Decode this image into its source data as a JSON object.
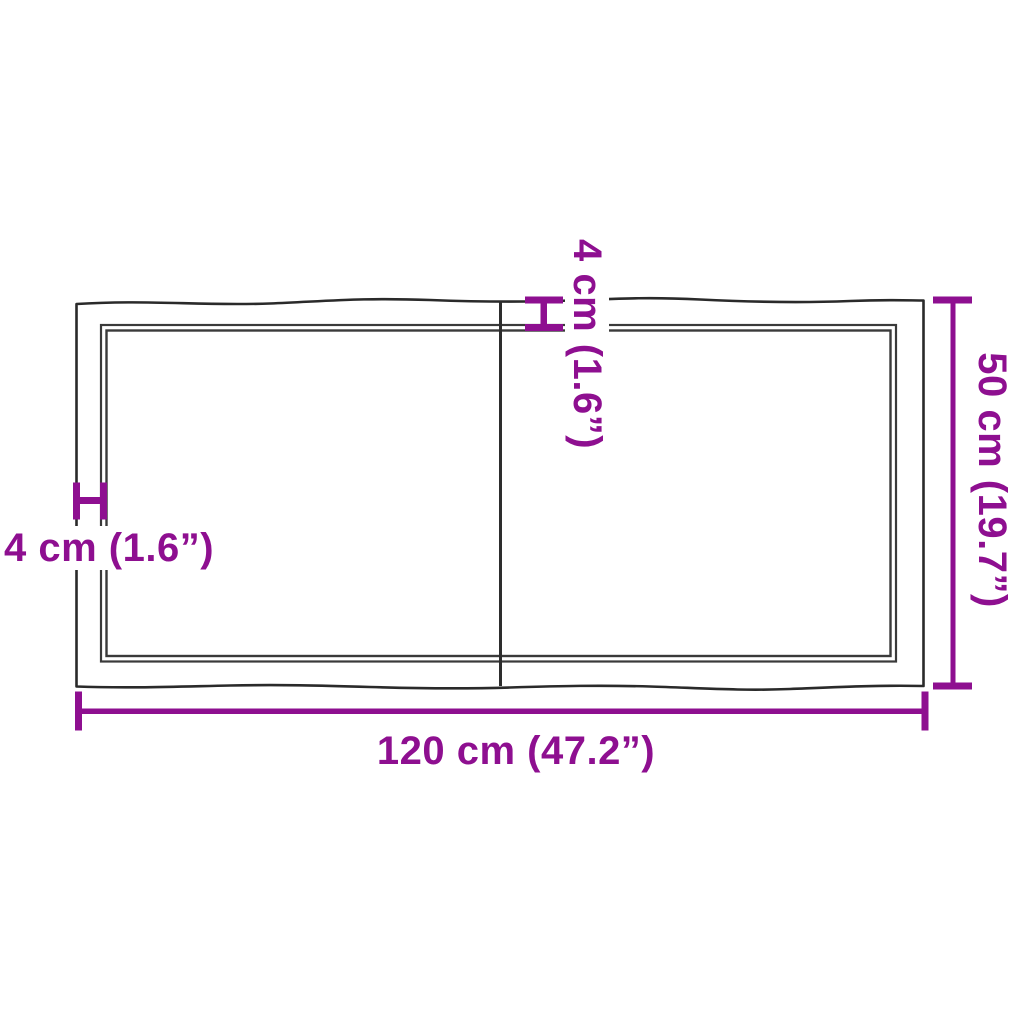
{
  "diagram": {
    "type": "product-dimension-diagram",
    "subject": "tabletop with live edges, two boards joined by a center seam",
    "colors": {
      "dimension_accent": "#8E0F90",
      "outline": "#2A2A2A",
      "inner_outline": "#3A3A3A",
      "background": "#FFFFFF"
    },
    "dimensions": {
      "width": "120 cm (47.2”)",
      "height": "50 cm (19.7”)",
      "edge_top": "4 cm (1.6”)",
      "edge_left": "4 cm (1.6”)"
    }
  }
}
